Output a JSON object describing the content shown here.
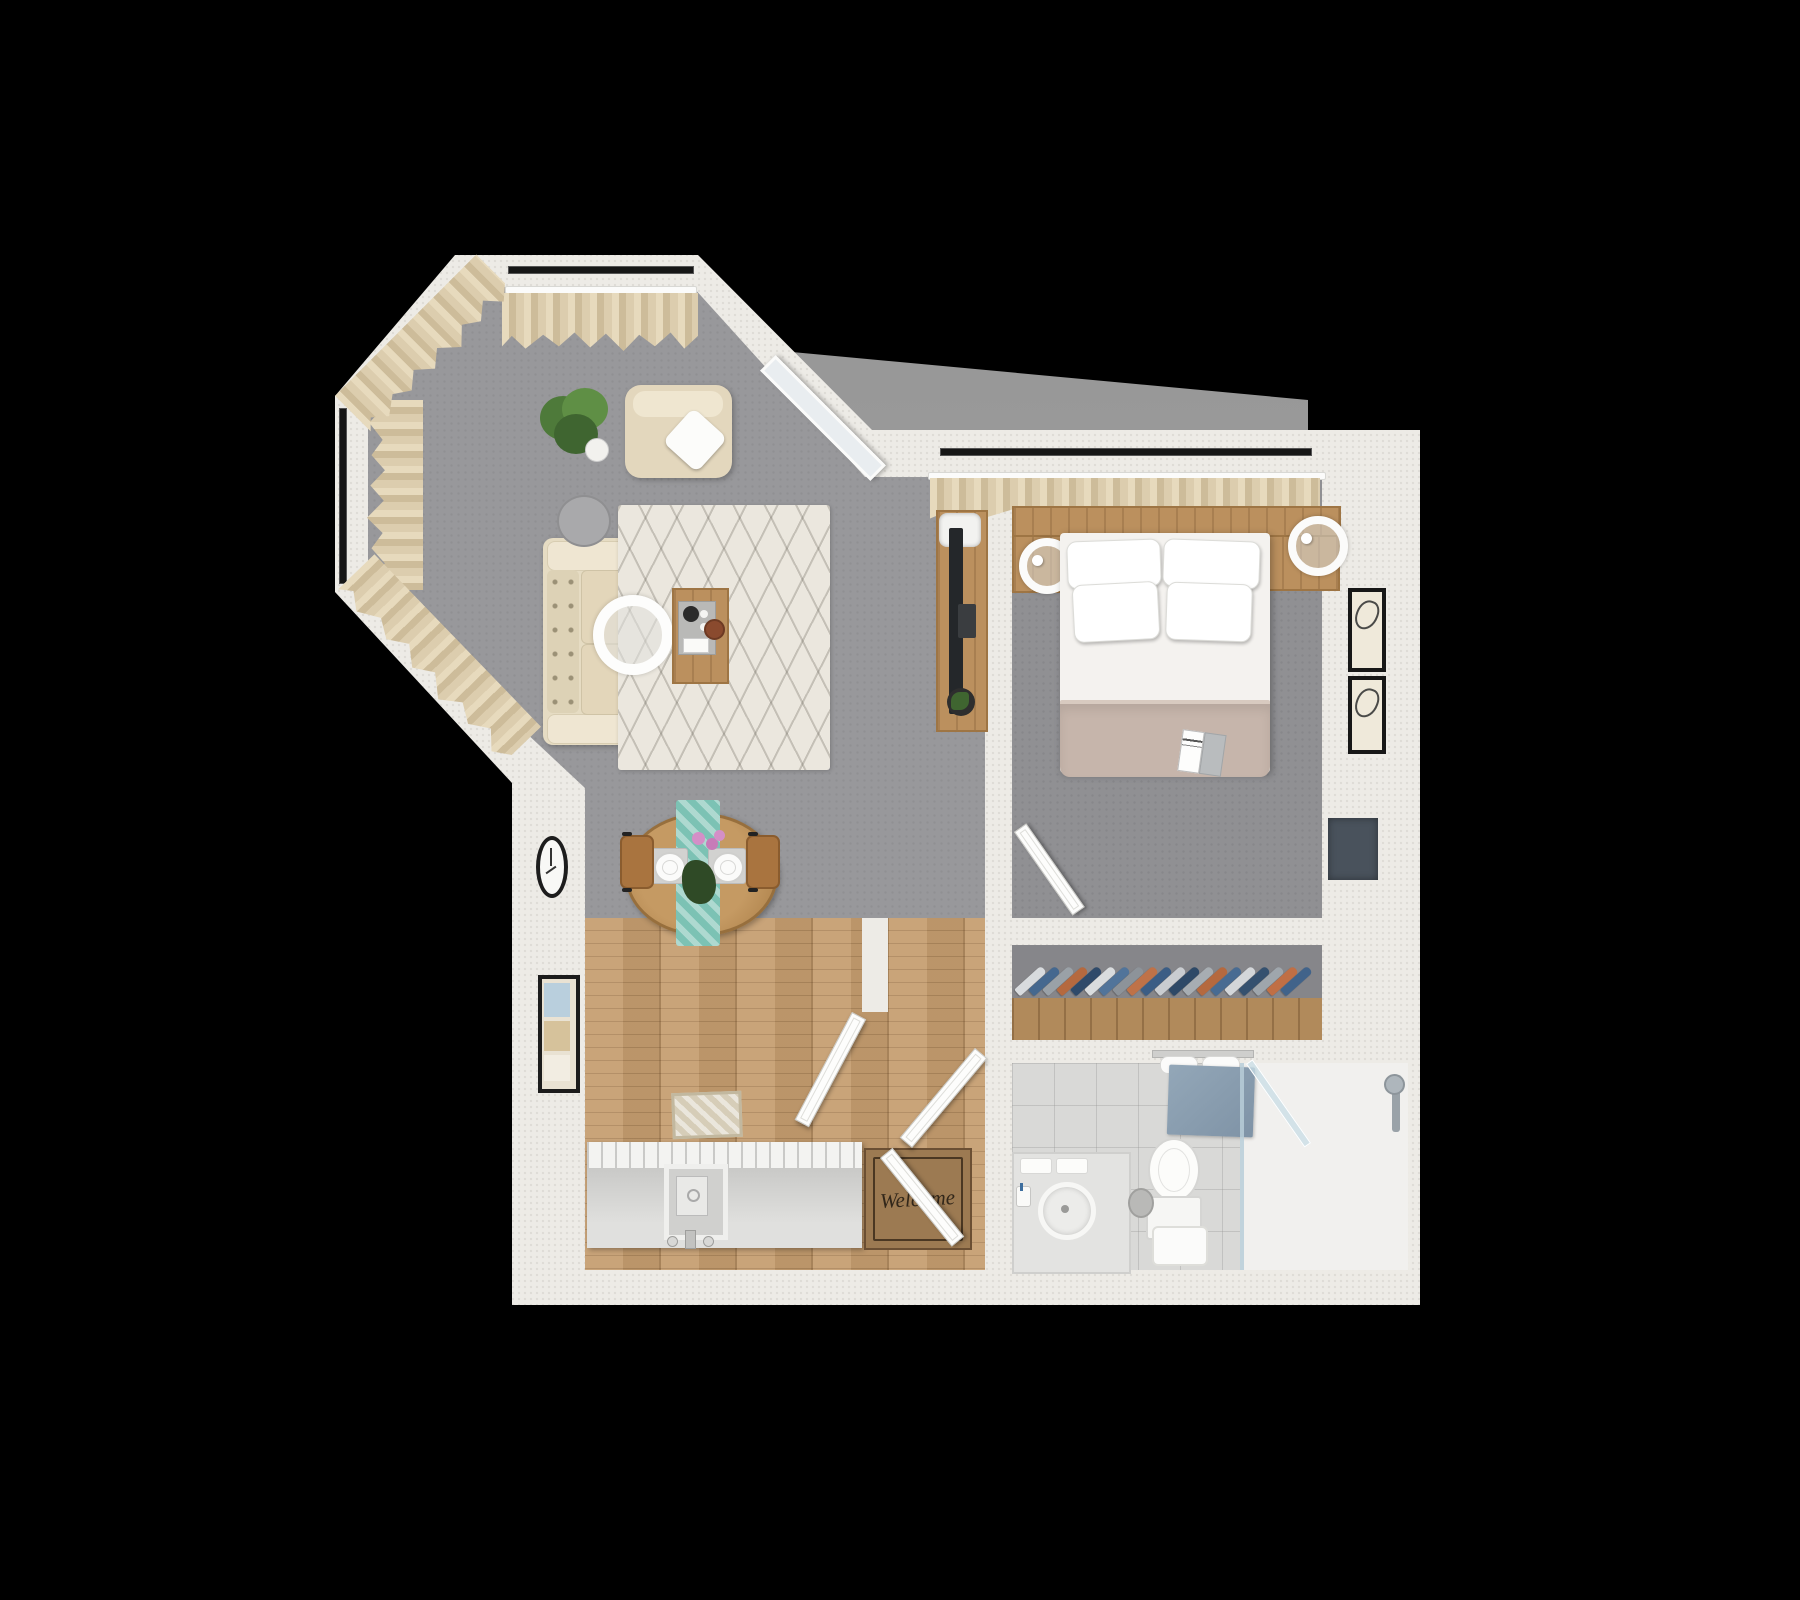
{
  "scene": {
    "type": "3d-floor-plan-top-down-rendering",
    "background_color": "#000000",
    "wall_color": "#edebe6",
    "palette": {
      "living_carpet": "#98989b",
      "bedroom_carpet": "#909093",
      "wood_floor": "#c59d6f",
      "bathroom_tile": "#d9d9d7",
      "curtain": "#dccdae",
      "upholstery_cream": "#e6dcc3",
      "wood_furniture": "#bb905e",
      "duvet_taupe": "#c6b5ab",
      "table_runner_teal": "#7cc2b4",
      "bath_mat_blue": "#8ba0b2",
      "mat_brown": "#9c7a52"
    }
  },
  "living_room": {
    "name": "living room",
    "items": [
      "bay windows with cream curtains",
      "potted plant",
      "armchair with white pillow",
      "cream sectional sofa",
      "arc floor lamp with white shade",
      "round gray side table",
      "diamond-pattern area rug",
      "wooden coffee table with coffee tray and bowl",
      "leaning full-length mirror",
      "tv console with flatscreen tv, magazines and plant",
      "oval wall clock"
    ]
  },
  "dining_area": {
    "name": "dining area",
    "items": [
      "round wooden dining table",
      "teal patterned table runner",
      "two place settings with plates",
      "pink flower centerpiece",
      "two wooden chairs"
    ]
  },
  "kitchen_entry": {
    "name": "kitchen and entry",
    "items": [
      "kitchen counter with sink and faucet",
      "small beige rug",
      "framed artwork",
      "welcome door mat",
      "entry door",
      "interior doors"
    ],
    "welcome_mat": {
      "text": "Welcome"
    }
  },
  "bedroom": {
    "name": "bedroom",
    "items": [
      "window with cream curtains",
      "headboard shelf",
      "double bed with four white pillows",
      "taupe duvet",
      "open magazine on bed",
      "two wooden nightstands with round white lamps",
      "two framed abstract line-art prints",
      "wall-mounted tv",
      "bedroom door"
    ]
  },
  "closet": {
    "name": "closet",
    "items": [
      "clothes hanging on rail",
      "wooden wardrobe unit"
    ],
    "clothes_colors": [
      "#d8dbde",
      "#45688f",
      "#9aa1a7",
      "#b5693f",
      "#2f4a6a",
      "#d9dcde",
      "#51749a",
      "#8d9399",
      "#bf7248",
      "#3b5d85",
      "#c9ccd0",
      "#2e4967",
      "#a7adb2",
      "#b5693f",
      "#486b92",
      "#d3d6d9",
      "#35516f",
      "#9fa6ac",
      "#c06f45",
      "#41638a"
    ]
  },
  "bathroom": {
    "name": "bathroom",
    "items": [
      "towel rack with towels",
      "blue bath mat",
      "toilet",
      "vanity with round basin",
      "folded towels",
      "toothbrush cup",
      "waste bin",
      "shower stool",
      "walk-in shower with glass panel",
      "shower fixture"
    ]
  }
}
